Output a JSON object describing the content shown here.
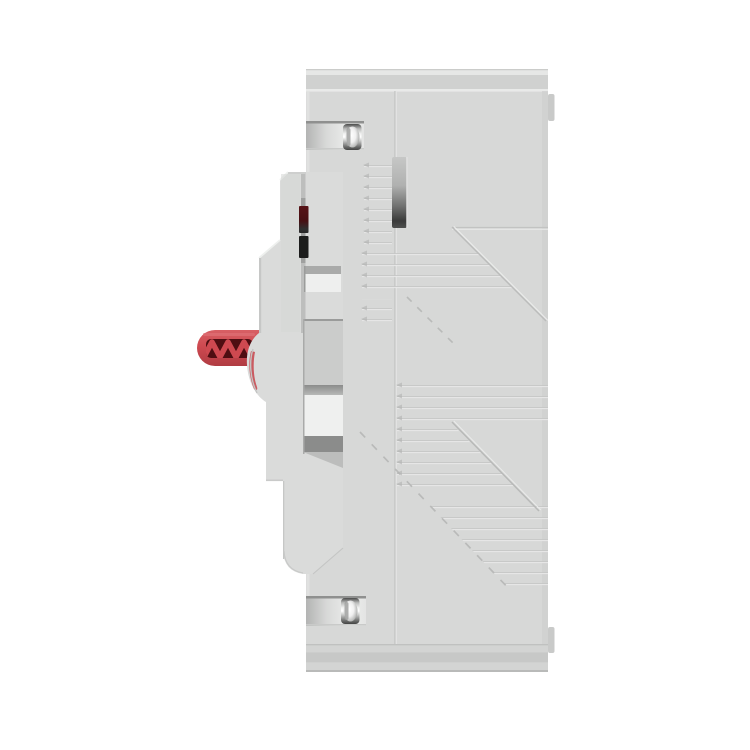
{
  "meta": {
    "type": "product-photo",
    "subject": "Molded case circuit breaker, side profile view",
    "description": "3D product render on a white background: right-side profile of a light gray molded case circuit breaker (MCCB). A red toggle handle with truss-style grip cutouts protrudes to the left. The stepped front cover edge shows a dark trip-indicator window, two chrome cover screws sit in recessed notches, and the case side carries molded horizontal rib lines and diagonal chevron texture with small rail tabs on the rear edge."
  },
  "colors": {
    "background": "#ffffff",
    "case_base": "#d7d8d7",
    "case_top_band": "#d0d1d0",
    "case_highlight": "#e9eae9",
    "case_bottom_band": "#c7c8c7",
    "cover_face": "#dadbda",
    "rib_line": "#c6c7c6",
    "recess_wall": "#cbcccb",
    "recess_floor": "#eff0ef",
    "recess_shadow": "#8b8c8b",
    "slot_dark": "#3a3b3a",
    "indicator_maroon": "#571317",
    "slot_black": "#1c1d1c",
    "handle_red": "#ce4950",
    "handle_red_dark": "#4f0e12",
    "handle_red_deep": "#b03c43",
    "screw_chrome_light": "#ffffff",
    "screw_chrome_dark": "#434443",
    "tab_gray": "#c9cac9"
  },
  "parts": {
    "main_case": "Molded case body, side face",
    "front_cover": "Stepped front cover edge",
    "toggle_handle": "Red toggle handle",
    "handle_grip_cutouts": "Handle truss grip cutouts",
    "handle_pivot_hub": "Handle pivot hub",
    "trip_indicator_window": "Trip indicator window (dark red)",
    "auxiliary_slot": "Auxiliary slot (black)",
    "case_vent_slot": "Vertical recessed vent slot",
    "mechanism_recess": "Mechanism recess window",
    "cover_screw_top": "Upper chrome cover screw",
    "cover_screw_bottom": "Lower chrome cover screw",
    "rail_tab_top": "Rear rail tab, upper",
    "rail_tab_bottom": "Rear rail tab, lower",
    "mold_parting_line": "Vertical mold parting line",
    "rib_texture": "Horizontal molded rib texture",
    "chevron_texture": "Diagonal chevron molded texture"
  }
}
